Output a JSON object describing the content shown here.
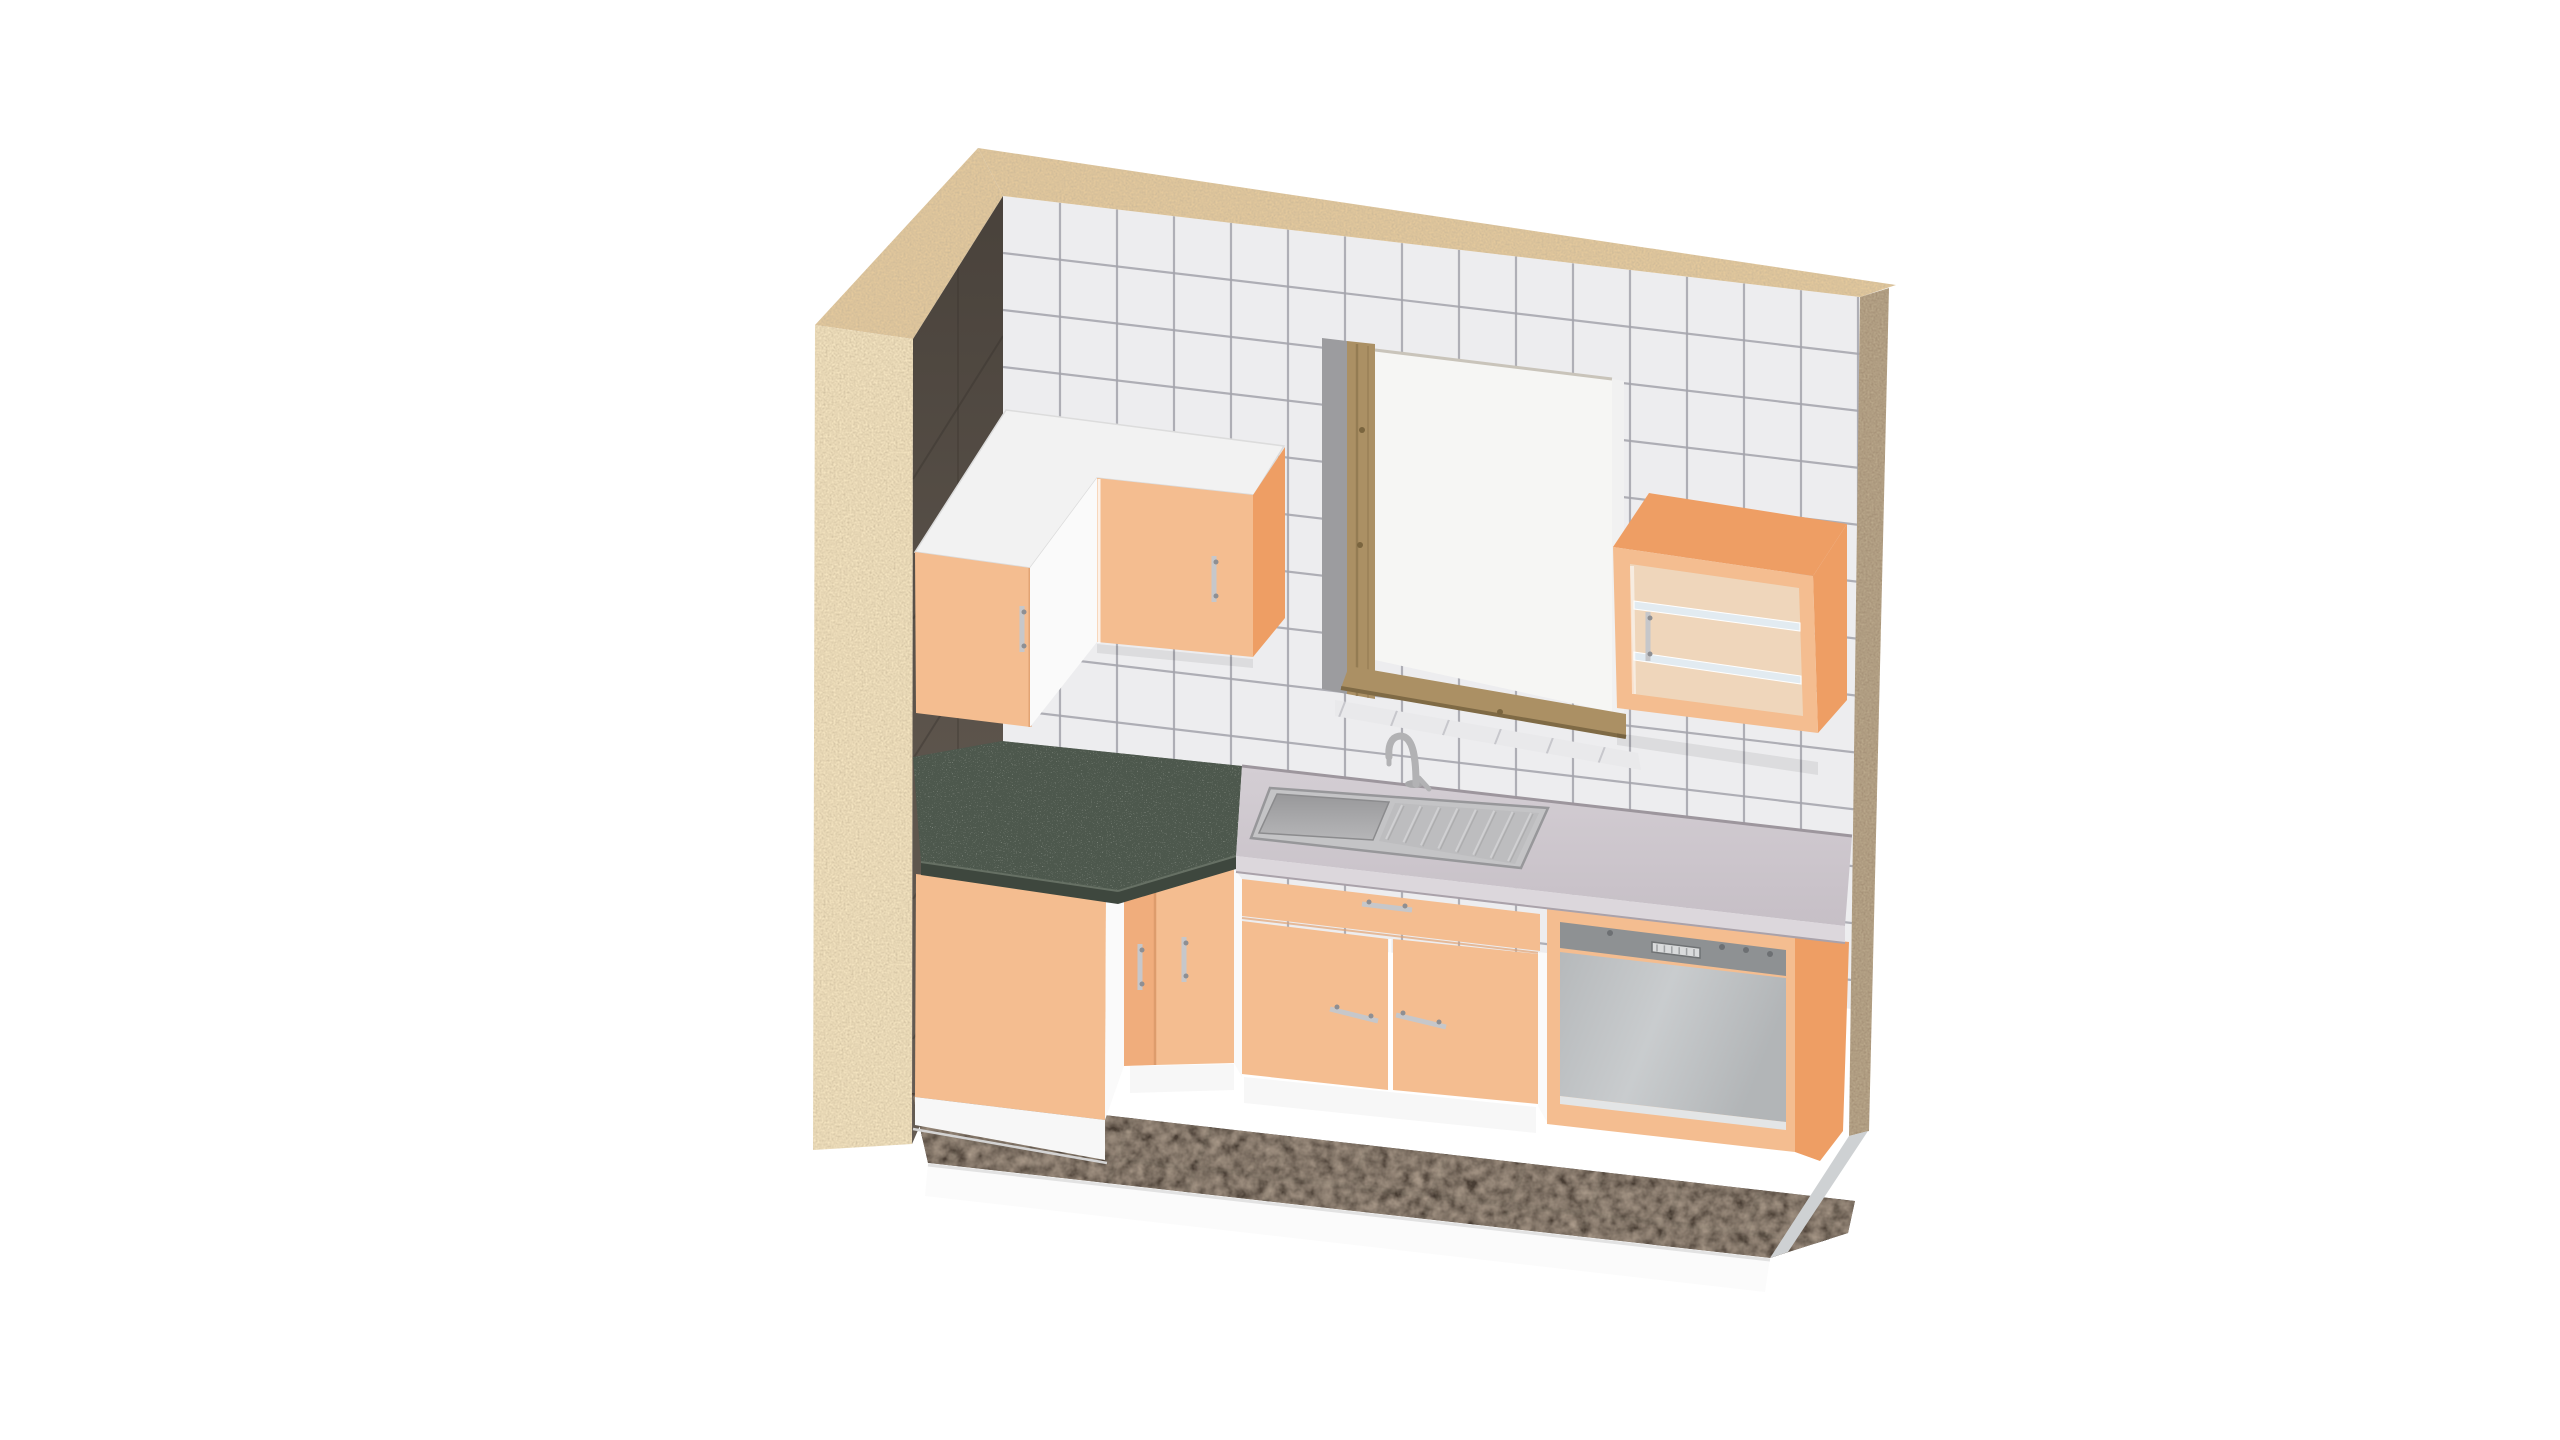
{
  "app": {
    "title": "3D kitchen room render"
  },
  "scene": {
    "view": "isometric room corner",
    "room": {
      "back_wall": "white square ceramic tiles",
      "left_wall_interior": "dark brown tiles",
      "exterior_walls": "sand colored plaster",
      "floor": "dark brown ceramic tiles on white slab"
    },
    "window": {
      "frame": "pine wood",
      "pane": "bright daylight",
      "reveal": "gray"
    },
    "furniture": [
      {
        "name": "corner-wall-cabinet",
        "doors": 2,
        "finish": "peach",
        "top": "white"
      },
      {
        "name": "glass-front-wall-cabinet",
        "doors": 1,
        "shelves": 2,
        "finish": "peach"
      },
      {
        "name": "left-base-cabinet",
        "finish": "peach",
        "worktop": "green tiles"
      },
      {
        "name": "corner-base-cabinet",
        "doors": 2,
        "finish": "peach",
        "worktop": "green tiles"
      },
      {
        "name": "sink-base-cabinet",
        "drawers": 1,
        "doors": 2,
        "finish": "peach",
        "worktop": "gray laminate"
      },
      {
        "name": "sink",
        "type": "basin with drainboard",
        "faucet": "gooseneck mixer"
      },
      {
        "name": "dishwasher",
        "type": "built-under",
        "front": "gray steel panel"
      }
    ]
  },
  "palette": {
    "bg": "#ffffff",
    "tile": "#ededef",
    "tile_grout": "#a4a4ac",
    "sill_tile": "#e9e9eb",
    "wall_top": "#e4c99d",
    "wall_front": "#f4e4c0",
    "wall_edge_right": "#a69278",
    "window_reveal": "#9c9c9f",
    "window_wood": "#ab9064",
    "window_wood_dark": "#7f6a45",
    "window_pane": "#f6f6f4",
    "cab_front": "#f4bd90",
    "cab_front_dark": "#f0ad7c",
    "cab_side": "#ee9e64",
    "cab_top": "#f2f2f2",
    "cab_white": "#fafafa",
    "glass_back": "#eccfae",
    "glass_shelf": "#dde8ef",
    "handle": "#c6c7ca",
    "handle_dark": "#8e8f93",
    "counter_top": "#cbc4cb",
    "counter_front": "#dcd7dc",
    "green_tile": "#4e584d",
    "green_grout": "#39423a",
    "green_edge": "#3e473e",
    "sink_rim": "#c4c4c6",
    "sink_board": "#bdbdbf",
    "faucet": "#b2b2b4",
    "dw_strip": "#8e9193",
    "dw_display": "#d9dbdc",
    "dw_knob": "#6d7073",
    "plinth": "#f7f7f7",
    "floor_tile": "#4a3e34",
    "floor_grout": "#241d18",
    "slab_front": "#fbfbfb",
    "slab_right": "#ced1d3",
    "seam": "#d4d4d4"
  }
}
